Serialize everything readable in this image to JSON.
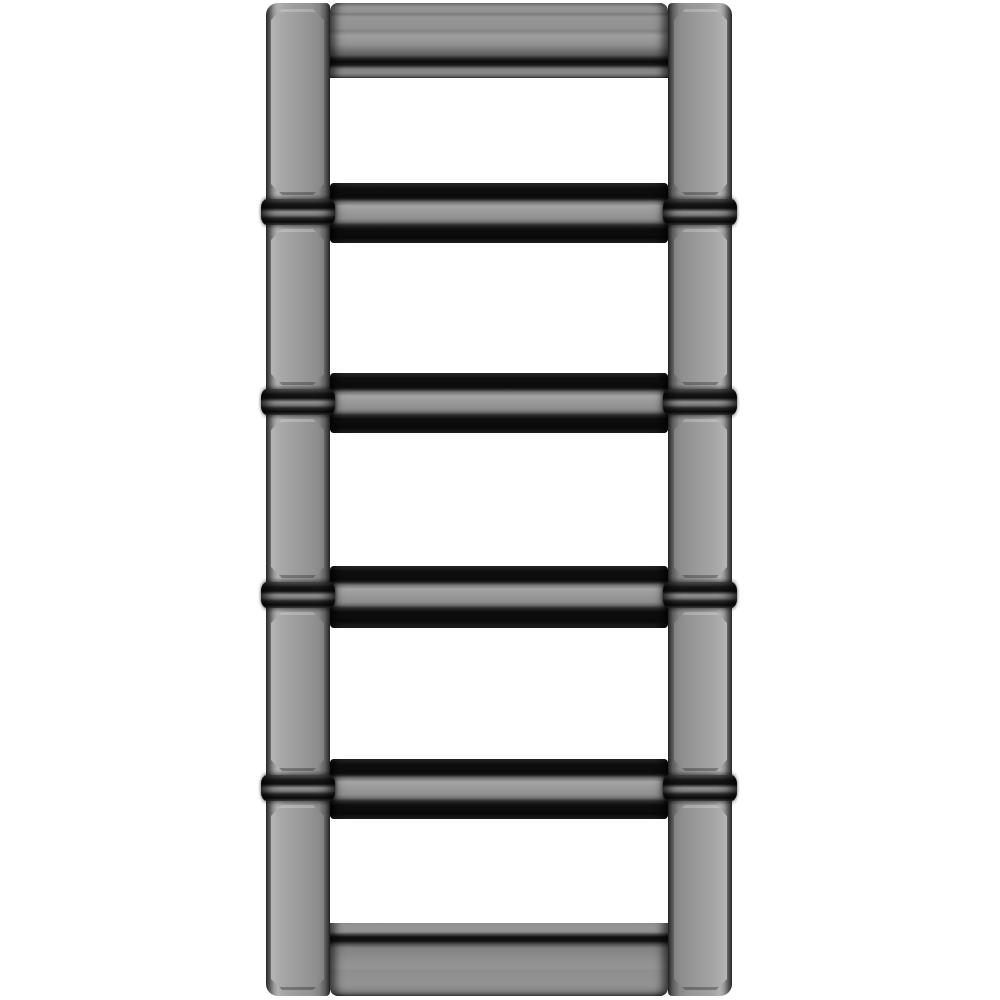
{
  "scene": {
    "description": "Product photograph of a five-link polished gunmetal-gray metal bracelet segment shaped like a ladder, standing vertically on a plain white background",
    "object": {
      "type": "metal-link-ladder",
      "link_count": 5,
      "hinge_ring_count": 4,
      "finish": "polished gunmetal gray",
      "colors": {
        "background": "#ffffff",
        "metal_base": "#949494",
        "metal_panel": "#9a9a9a",
        "metal_light": "#b2b2b2",
        "metal_dark": "#3c3c3c",
        "shadow_black": "#0b0b0b"
      },
      "geometry": {
        "left": 266,
        "top": 3,
        "width": 466,
        "height": 993,
        "rail_width": 64,
        "ring_offset_in_junction": 16,
        "ring_height": 26,
        "ring_overhang": 5,
        "rows": [
          {
            "type": "cap_top",
            "h": 75
          },
          {
            "type": "opening",
            "h": 105
          },
          {
            "type": "junction",
            "h": 60
          },
          {
            "type": "opening",
            "h": 130
          },
          {
            "type": "junction",
            "h": 60
          },
          {
            "type": "opening",
            "h": 133
          },
          {
            "type": "junction",
            "h": 62
          },
          {
            "type": "opening",
            "h": 131
          },
          {
            "type": "junction",
            "h": 60
          },
          {
            "type": "opening",
            "h": 104
          },
          {
            "type": "cap_bottom",
            "h": 73
          }
        ]
      }
    }
  }
}
